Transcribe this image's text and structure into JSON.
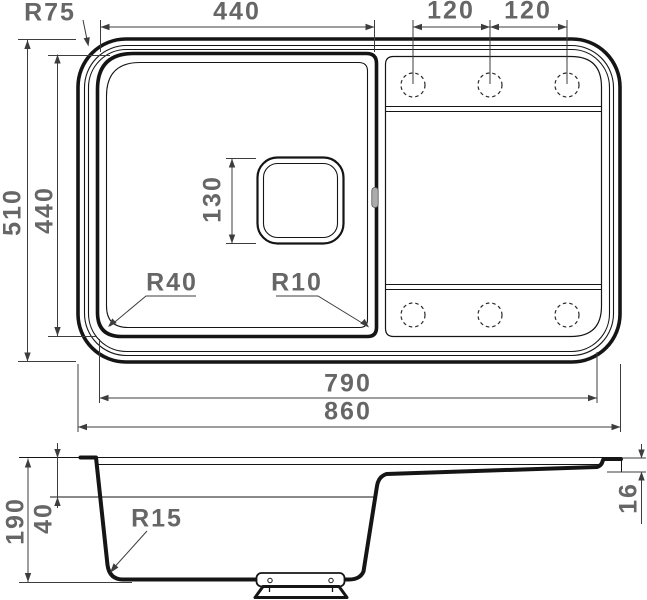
{
  "drawing_type": "sink technical dimension drawing",
  "top_view": {
    "corner_radius": "R75",
    "bowl_width": "440",
    "hole_gap_1": "120",
    "hole_gap_2": "120",
    "overall_height": "510",
    "bowl_height": "440",
    "drain_size": "130",
    "bowl_corner_radius_left": "R40",
    "bowl_corner_radius_right": "R10",
    "inner_width": "790",
    "overall_width": "860"
  },
  "section_view": {
    "total_depth": "190",
    "ledge_depth": "40",
    "bottom_radius": "R15",
    "edge_thickness": "16"
  },
  "colors": {
    "outline": "#151515",
    "dim_line": "#3d3d3d",
    "dim_text": "#666666"
  }
}
